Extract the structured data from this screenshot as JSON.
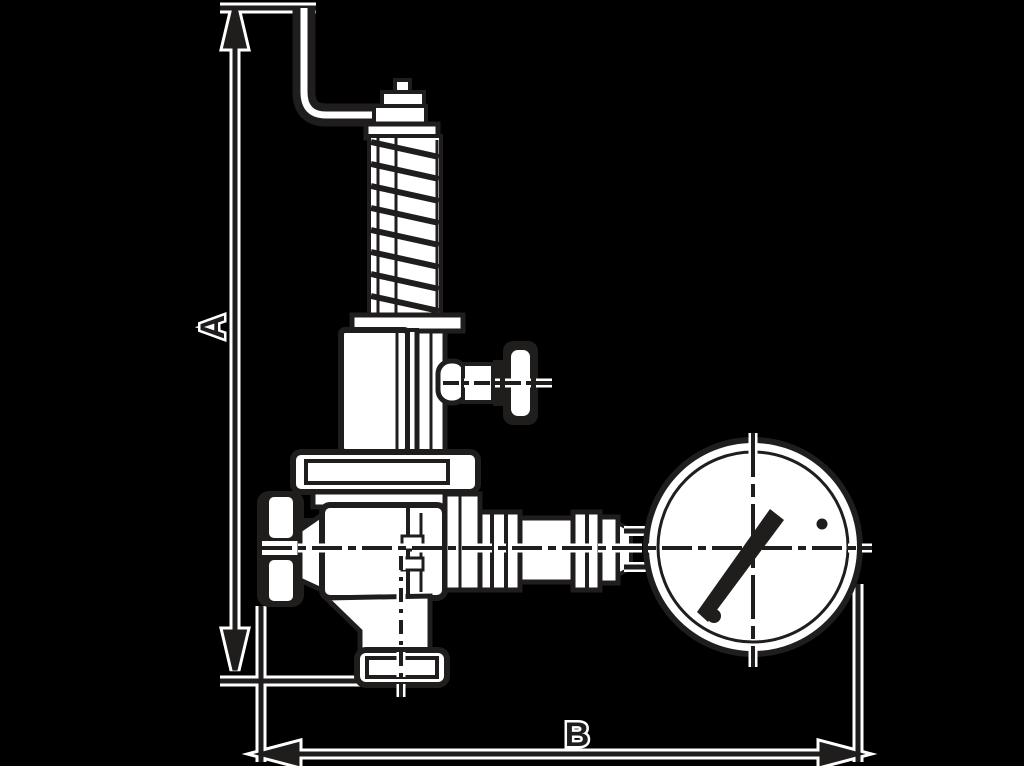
{
  "canvas": {
    "width": 1024,
    "height": 766,
    "background": "#000000",
    "ink": "#201d1d",
    "paper": "#ffffff"
  },
  "dimension_annotations": {
    "vertical_label": "A",
    "horizontal_label": "B"
  },
  "drawing": {
    "type": "technical-line-drawing",
    "subject": "angle safety valve with test lever, spring bonnet, two handwheels and pressure gauge",
    "parts": [
      "test-lever",
      "spring",
      "spring-bonnet",
      "side-handwheel",
      "inlet-handwheel",
      "valve-body",
      "outlet-flange",
      "union-fittings",
      "pressure-gauge",
      "gauge-needle"
    ]
  }
}
